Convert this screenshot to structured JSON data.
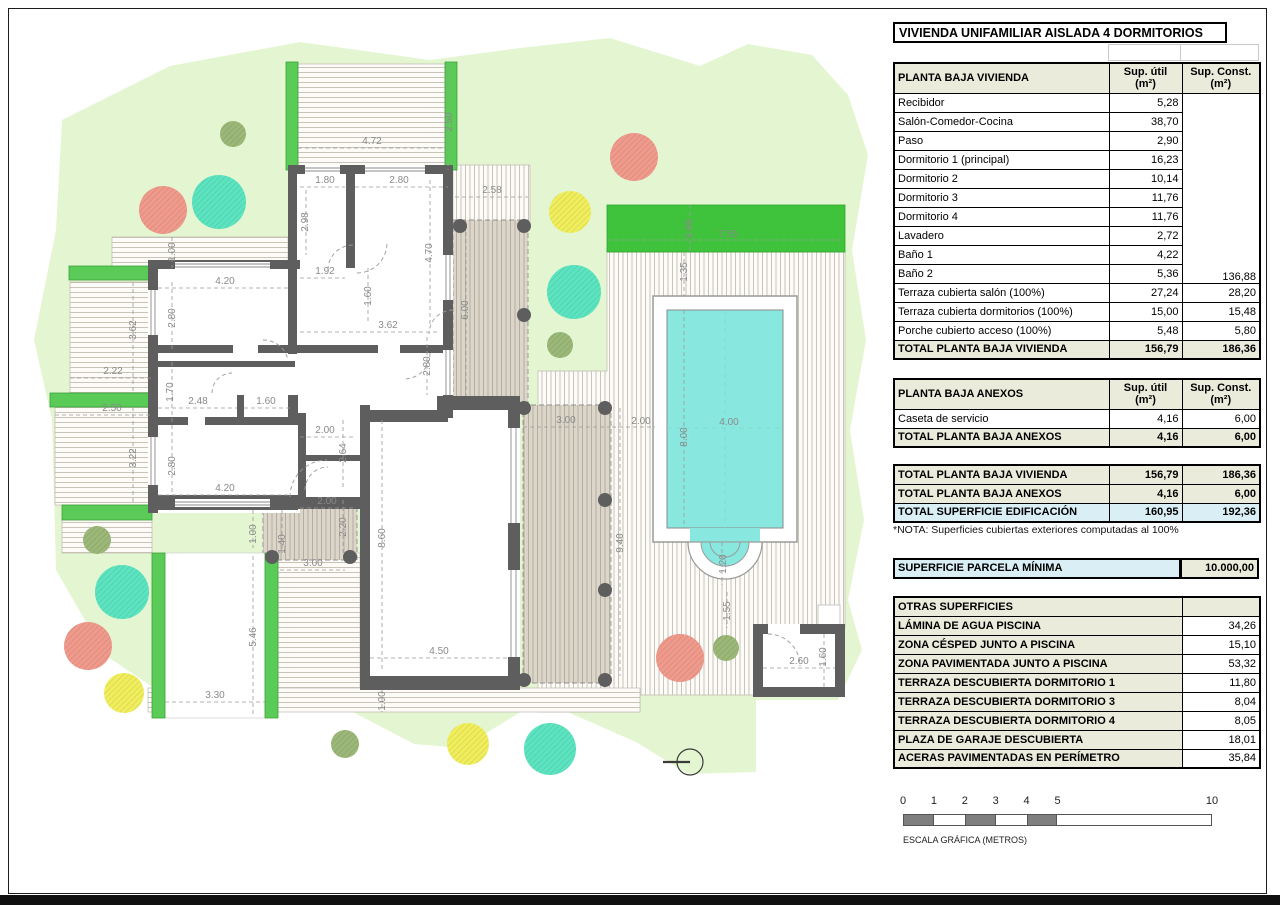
{
  "title": "VIVIENDA UNIFAMILIAR AISLADA 4 DORMITORIOS",
  "tables": {
    "vivienda": {
      "header": [
        "PLANTA BAJA VIVIENDA",
        "Sup. útil\n(m²)",
        "Sup. Const.\n(m²)"
      ],
      "rows": [
        [
          "Recibidor",
          "5,28",
          ""
        ],
        [
          "Salón-Comedor-Cocina",
          "38,70",
          ""
        ],
        [
          "Paso",
          "2,90",
          ""
        ],
        [
          "Dormitorio 1 (principal)",
          "16,23",
          ""
        ],
        [
          "Dormitorio 2",
          "10,14",
          ""
        ],
        [
          "Dormitorio 3",
          "11,76",
          ""
        ],
        [
          "Dormitorio 4",
          "11,76",
          ""
        ],
        [
          "Lavadero",
          "2,72",
          ""
        ],
        [
          "Baño 1",
          "4,22",
          ""
        ],
        [
          "Baño 2",
          "5,36",
          "136,88"
        ],
        [
          "Terraza cubierta salón (100%)",
          "27,24",
          "28,20"
        ],
        [
          "Terraza cubierta dormitorios (100%)",
          "15,00",
          "15,48"
        ],
        [
          "Porche cubierto acceso (100%)",
          "5,48",
          "5,80"
        ]
      ],
      "merged_const_rows": 10,
      "total": [
        "TOTAL PLANTA BAJA VIVIENDA",
        "156,79",
        "186,36"
      ]
    },
    "anexos": {
      "header": [
        "PLANTA BAJA ANEXOS",
        "Sup. útil\n(m²)",
        "Sup. Const.\n(m²)"
      ],
      "rows": [
        [
          "Caseta de servicio",
          "4,16",
          "6,00"
        ]
      ],
      "total": [
        "TOTAL PLANTA BAJA ANEXOS",
        "4,16",
        "6,00"
      ]
    },
    "resumen": {
      "rows": [
        {
          "cells": [
            "TOTAL PLANTA BAJA VIVIENDA",
            "156,79",
            "186,36"
          ],
          "style": "beige"
        },
        {
          "cells": [
            "TOTAL PLANTA BAJA ANEXOS",
            "4,16",
            "6,00"
          ],
          "style": "beige"
        },
        {
          "cells": [
            "TOTAL SUPERFICIE EDIFICACIÓN",
            "160,95",
            "192,36"
          ],
          "style": "blue"
        }
      ],
      "note": "*NOTA: Superficies cubiertas exteriores computadas al 100%"
    },
    "parcela": {
      "label": "SUPERFICIE PARCELA MÍNIMA",
      "value": "10.000,00"
    },
    "otras": {
      "header": "OTRAS SUPERFICIES",
      "rows": [
        [
          "LÁMINA DE AGUA PISCINA",
          "34,26"
        ],
        [
          "ZONA CÉSPED JUNTO A PISCINA",
          "15,10"
        ],
        [
          "ZONA PAVIMENTADA JUNTO A PISCINA",
          "53,32"
        ],
        [
          "TERRAZA DESCUBIERTA DORMITORIO 1",
          "11,80"
        ],
        [
          "TERRAZA DESCUBIERTA DORMITORIO 3",
          "8,04"
        ],
        [
          "TERRAZA DESCUBIERTA DORMITORIO 4",
          "8,05"
        ],
        [
          "PLAZA DE GARAJE DESCUBIERTA",
          "18,01"
        ],
        [
          "ACERAS PAVIMENTADAS EN PERÍMETRO",
          "35,84"
        ]
      ]
    }
  },
  "scale_bar": {
    "ticks": [
      {
        "label": "0",
        "m": 0
      },
      {
        "label": "1",
        "m": 1
      },
      {
        "label": "2",
        "m": 2
      },
      {
        "label": "3",
        "m": 3
      },
      {
        "label": "4",
        "m": 4
      },
      {
        "label": "5",
        "m": 5
      },
      {
        "label": "10",
        "m": 10
      }
    ],
    "filled_segments": [
      [
        0,
        1
      ],
      [
        2,
        3
      ],
      [
        4,
        5
      ]
    ],
    "px_per_m": 30.9,
    "caption": "ESCALA GRÁFICA (METROS)"
  },
  "plan": {
    "colors": {
      "parcel": "#e4f6d1",
      "lawn": "#3fc23c",
      "pergola": "#5bcb57",
      "wall": "#5e5e5e",
      "pool_water": "#88e8df",
      "table_beige": "#ebebdc",
      "table_blue": "#d9eff5",
      "tree_salmon": "#f09a8c",
      "tree_teal": "#5ce4c0",
      "tree_yellow": "#f0ee5c",
      "tree_olive": "#9bb878"
    },
    "dimensions": [
      {
        "t": "2.50",
        "x": 452,
        "y": 122,
        "v": 1
      },
      {
        "t": "4.72",
        "x": 372,
        "y": 144
      },
      {
        "t": "1.80",
        "x": 325,
        "y": 183
      },
      {
        "t": "2.80",
        "x": 399,
        "y": 183
      },
      {
        "t": "2.98",
        "x": 308,
        "y": 222,
        "v": 1
      },
      {
        "t": "4.70",
        "x": 432,
        "y": 253,
        "v": 1
      },
      {
        "t": "2.58",
        "x": 492,
        "y": 193
      },
      {
        "t": "6.00",
        "x": 468,
        "y": 310,
        "v": 1
      },
      {
        "t": "2.00",
        "x": 692,
        "y": 229,
        "v": 1
      },
      {
        "t": "7.55",
        "x": 728,
        "y": 237
      },
      {
        "t": "1.35",
        "x": 687,
        "y": 272,
        "v": 1
      },
      {
        "t": "8.00",
        "x": 687,
        "y": 437,
        "v": 1
      },
      {
        "t": "4.00",
        "x": 729,
        "y": 425
      },
      {
        "t": "1.20",
        "x": 726,
        "y": 564,
        "v": 1
      },
      {
        "t": "1.55",
        "x": 730,
        "y": 611,
        "v": 1
      },
      {
        "t": "1.00",
        "x": 175,
        "y": 252,
        "v": 1
      },
      {
        "t": "4.20",
        "x": 225,
        "y": 284
      },
      {
        "t": "2.80",
        "x": 175,
        "y": 318,
        "v": 1
      },
      {
        "t": "1.92",
        "x": 325,
        "y": 274
      },
      {
        "t": "1.60",
        "x": 371,
        "y": 296,
        "v": 1
      },
      {
        "t": "3.62",
        "x": 388,
        "y": 328
      },
      {
        "t": "2.80",
        "x": 430,
        "y": 366,
        "v": 1
      },
      {
        "t": "3.62",
        "x": 136,
        "y": 330,
        "v": 1
      },
      {
        "t": "2.22",
        "x": 113,
        "y": 374
      },
      {
        "t": "2.50",
        "x": 112,
        "y": 411
      },
      {
        "t": "3.22",
        "x": 136,
        "y": 458,
        "v": 1
      },
      {
        "t": "1.70",
        "x": 173,
        "y": 392,
        "v": 1
      },
      {
        "t": "2.48",
        "x": 198,
        "y": 404
      },
      {
        "t": "1.60",
        "x": 266,
        "y": 404
      },
      {
        "t": "2.80",
        "x": 175,
        "y": 466,
        "v": 1
      },
      {
        "t": "4.20",
        "x": 225,
        "y": 491
      },
      {
        "t": "2.00",
        "x": 325,
        "y": 433
      },
      {
        "t": "2.64",
        "x": 346,
        "y": 453,
        "v": 1
      },
      {
        "t": "2.00",
        "x": 327,
        "y": 504
      },
      {
        "t": "2.20",
        "x": 346,
        "y": 527,
        "v": 1
      },
      {
        "t": "1.00",
        "x": 256,
        "y": 534,
        "v": 1
      },
      {
        "t": "1.40",
        "x": 285,
        "y": 544,
        "v": 1
      },
      {
        "t": "3.00",
        "x": 313,
        "y": 566
      },
      {
        "t": "8.60",
        "x": 385,
        "y": 538,
        "v": 1
      },
      {
        "t": "5.46",
        "x": 256,
        "y": 637,
        "v": 1
      },
      {
        "t": "3.30",
        "x": 215,
        "y": 698
      },
      {
        "t": "4.50",
        "x": 439,
        "y": 654
      },
      {
        "t": "1.00",
        "x": 385,
        "y": 701,
        "v": 1
      },
      {
        "t": "3.00",
        "x": 566,
        "y": 423
      },
      {
        "t": "2.00",
        "x": 641,
        "y": 424
      },
      {
        "t": "9.40",
        "x": 623,
        "y": 543,
        "v": 1
      },
      {
        "t": "2.60",
        "x": 799,
        "y": 664
      },
      {
        "t": "1.60",
        "x": 826,
        "y": 657,
        "v": 1
      }
    ],
    "trees": [
      {
        "x": 233,
        "y": 134,
        "r": 13,
        "type": "olive"
      },
      {
        "x": 163,
        "y": 210,
        "r": 24,
        "type": "salmon"
      },
      {
        "x": 219,
        "y": 202,
        "r": 27,
        "type": "teal"
      },
      {
        "x": 634,
        "y": 157,
        "r": 24,
        "type": "salmon"
      },
      {
        "x": 570,
        "y": 212,
        "r": 21,
        "type": "yellow"
      },
      {
        "x": 574,
        "y": 292,
        "r": 27,
        "type": "teal"
      },
      {
        "x": 560,
        "y": 345,
        "r": 13,
        "type": "olive"
      },
      {
        "x": 97,
        "y": 540,
        "r": 14,
        "type": "olive"
      },
      {
        "x": 122,
        "y": 592,
        "r": 27,
        "type": "teal"
      },
      {
        "x": 88,
        "y": 646,
        "r": 24,
        "type": "salmon"
      },
      {
        "x": 124,
        "y": 693,
        "r": 20,
        "type": "yellow"
      },
      {
        "x": 345,
        "y": 744,
        "r": 14,
        "type": "olive"
      },
      {
        "x": 468,
        "y": 744,
        "r": 21,
        "type": "yellow"
      },
      {
        "x": 550,
        "y": 749,
        "r": 26,
        "type": "teal"
      },
      {
        "x": 680,
        "y": 658,
        "r": 24,
        "type": "salmon"
      },
      {
        "x": 726,
        "y": 648,
        "r": 13,
        "type": "olive"
      }
    ],
    "columns": [
      [
        460,
        226
      ],
      [
        524,
        226
      ],
      [
        524,
        315
      ],
      [
        524,
        408
      ],
      [
        605,
        408
      ],
      [
        605,
        500
      ],
      [
        605,
        590
      ],
      [
        524,
        680
      ],
      [
        605,
        680
      ],
      [
        272,
        557
      ],
      [
        350,
        557
      ]
    ]
  }
}
